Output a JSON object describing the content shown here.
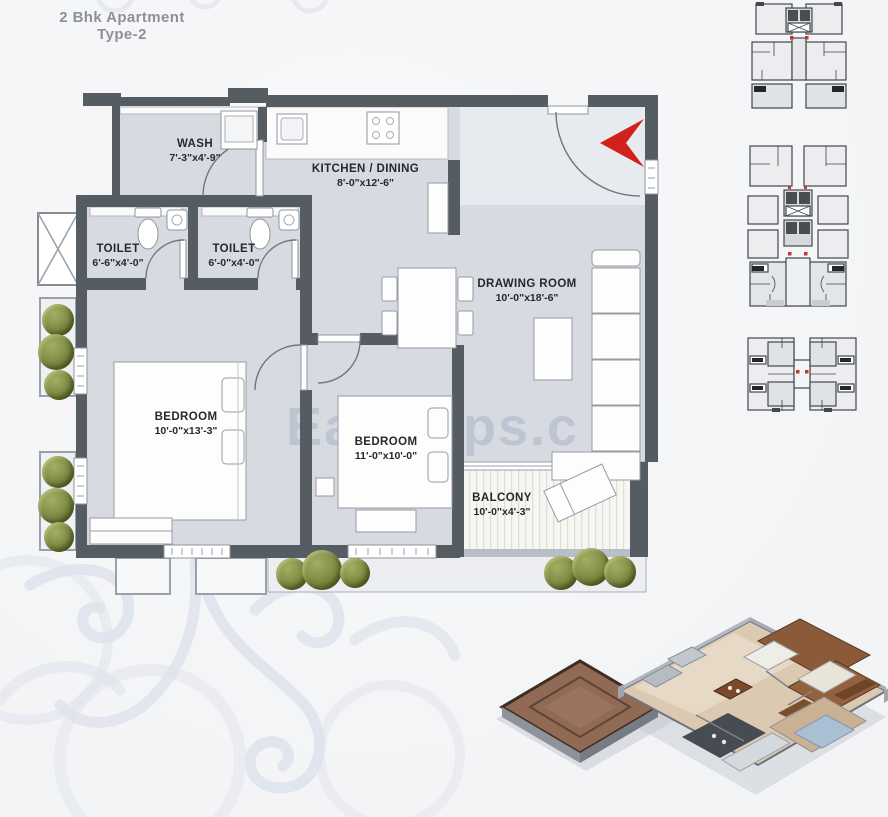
{
  "title": {
    "line1": "2 Bhk Apartment",
    "line2": "Type-2"
  },
  "rooms": [
    {
      "id": "wash",
      "name": "WASH",
      "dims": "7'-3\"x4'-9\""
    },
    {
      "id": "kitchen",
      "name": "KITCHEN / DINING",
      "dims": "8'-0\"x12'-6\""
    },
    {
      "id": "toilet1",
      "name": "TOILET",
      "dims": "6'-6\"x4'-0\""
    },
    {
      "id": "toilet2",
      "name": "TOILET",
      "dims": "6'-0\"x4'-0\""
    },
    {
      "id": "drawing",
      "name": "DRAWING ROOM",
      "dims": "10'-0\"x18'-6\""
    },
    {
      "id": "bedroom1",
      "name": "BEDROOM",
      "dims": "10'-0\"x13'-3\""
    },
    {
      "id": "bedroom2",
      "name": "BEDROOM",
      "dims": "11'-0\"x10'-0\""
    },
    {
      "id": "balcony",
      "name": "BALCONY",
      "dims": "10'-0\"x4'-3\""
    }
  ],
  "watermark": {
    "fragment_left": "Ea",
    "fragment_right": "ops.c"
  },
  "colors": {
    "wall": "#565d62",
    "floor": "#d7dae1",
    "entry_arrow_red": "#d2211c",
    "bush_green": "#87934b",
    "watermark": "#bac1cf",
    "ornament": "#dfe3ec",
    "title_text": "#8d9094"
  }
}
